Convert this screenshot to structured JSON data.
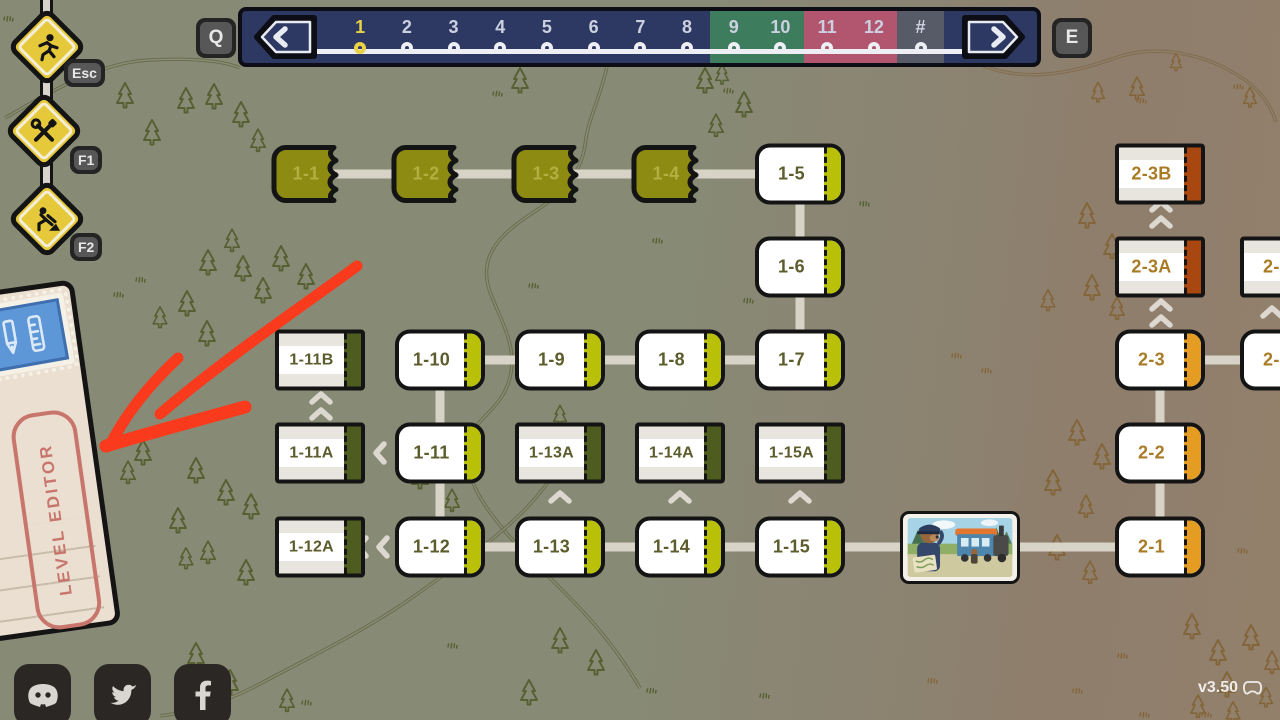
{
  "meta": {
    "version_label": "v3.50"
  },
  "topbar": {
    "prev_key": "Q",
    "next_key": "E",
    "current_world": "1",
    "worlds": [
      {
        "label": "1",
        "group": "navy"
      },
      {
        "label": "2",
        "group": "navy"
      },
      {
        "label": "3",
        "group": "navy"
      },
      {
        "label": "4",
        "group": "navy"
      },
      {
        "label": "5",
        "group": "navy"
      },
      {
        "label": "6",
        "group": "navy"
      },
      {
        "label": "7",
        "group": "navy"
      },
      {
        "label": "8",
        "group": "navy"
      },
      {
        "label": "9",
        "group": "green"
      },
      {
        "label": "10",
        "group": "green"
      },
      {
        "label": "11",
        "group": "red"
      },
      {
        "label": "12",
        "group": "red"
      },
      {
        "label": "#",
        "group": "gray"
      }
    ]
  },
  "hotkeys": [
    {
      "key": "Esc",
      "action": "exit",
      "icon": "runner-icon"
    },
    {
      "key": "F1",
      "action": "settings",
      "icon": "tools-icon"
    },
    {
      "key": "F2",
      "action": "construction",
      "icon": "worker-icon"
    }
  ],
  "level_editor": {
    "label": "LEVEL EDITOR"
  },
  "social": [
    {
      "name": "discord"
    },
    {
      "name": "twitter"
    },
    {
      "name": "facebook"
    }
  ],
  "colors": {
    "world1_stub": "#b9c008",
    "world1_bonus_stub": "#4e5c1f",
    "world1_done": "#8d8b11",
    "world2_stub": "#e49d22",
    "world2_bonus_stub": "#a8470f",
    "bar_navy": "#2e3963",
    "bar_green": "#3e7c5e",
    "bar_red": "#b2556e",
    "bar_gray": "#575b68",
    "highlight_yellow": "#e9d344",
    "sign_yellow": "#e6c93a",
    "path_gray": "#d8d3c7"
  },
  "map": {
    "nodes": [
      {
        "id": "1-1",
        "x": 315,
        "y": 174,
        "style": "done"
      },
      {
        "id": "1-2",
        "x": 435,
        "y": 174,
        "style": "done"
      },
      {
        "id": "1-3",
        "x": 555,
        "y": 174,
        "style": "done"
      },
      {
        "id": "1-4",
        "x": 675,
        "y": 174,
        "style": "done"
      },
      {
        "id": "1-5",
        "x": 800,
        "y": 174,
        "style": "open1"
      },
      {
        "id": "1-6",
        "x": 800,
        "y": 267,
        "style": "open1"
      },
      {
        "id": "1-7",
        "x": 800,
        "y": 360,
        "style": "open1"
      },
      {
        "id": "1-8",
        "x": 680,
        "y": 360,
        "style": "open1"
      },
      {
        "id": "1-9",
        "x": 560,
        "y": 360,
        "style": "open1"
      },
      {
        "id": "1-10",
        "x": 440,
        "y": 360,
        "style": "open1"
      },
      {
        "id": "1-11B",
        "x": 320,
        "y": 360,
        "style": "var1"
      },
      {
        "id": "1-11A",
        "x": 320,
        "y": 453,
        "style": "var1"
      },
      {
        "id": "1-11",
        "x": 440,
        "y": 453,
        "style": "open1"
      },
      {
        "id": "1-13A",
        "x": 560,
        "y": 453,
        "style": "var1"
      },
      {
        "id": "1-14A",
        "x": 680,
        "y": 453,
        "style": "var1"
      },
      {
        "id": "1-15A",
        "x": 800,
        "y": 453,
        "style": "var1"
      },
      {
        "id": "1-12A",
        "x": 320,
        "y": 547,
        "style": "var1"
      },
      {
        "id": "1-12",
        "x": 440,
        "y": 547,
        "style": "open1"
      },
      {
        "id": "1-13",
        "x": 560,
        "y": 547,
        "style": "open1"
      },
      {
        "id": "1-14",
        "x": 680,
        "y": 547,
        "style": "open1"
      },
      {
        "id": "1-15",
        "x": 800,
        "y": 547,
        "style": "open1"
      },
      {
        "id": "2-1",
        "x": 1160,
        "y": 547,
        "style": "open2"
      },
      {
        "id": "2-2",
        "x": 1160,
        "y": 453,
        "style": "open2"
      },
      {
        "id": "2-3",
        "x": 1160,
        "y": 360,
        "style": "open2"
      },
      {
        "id": "2-3A",
        "x": 1160,
        "y": 267,
        "style": "var2"
      },
      {
        "id": "2-3B",
        "x": 1160,
        "y": 174,
        "style": "var2"
      },
      {
        "id": "2-4",
        "x": 1285,
        "y": 267,
        "style": "var2"
      },
      {
        "id": "2-4",
        "x": 1285,
        "y": 360,
        "style": "open2"
      }
    ],
    "paths": [
      {
        "x1": 315,
        "y1": 174,
        "x2": 800,
        "y2": 174
      },
      {
        "x1": 800,
        "y1": 174,
        "x2": 800,
        "y2": 360
      },
      {
        "x1": 440,
        "y1": 360,
        "x2": 800,
        "y2": 360
      },
      {
        "x1": 440,
        "y1": 360,
        "x2": 440,
        "y2": 547
      },
      {
        "x1": 440,
        "y1": 547,
        "x2": 1160,
        "y2": 547
      },
      {
        "x1": 1160,
        "y1": 547,
        "x2": 1160,
        "y2": 360
      },
      {
        "x1": 1160,
        "y1": 360,
        "x2": 1290,
        "y2": 360
      }
    ],
    "chevrons": [
      {
        "x": 321,
        "y": 398,
        "dir": "up"
      },
      {
        "x": 321,
        "y": 414,
        "dir": "up"
      },
      {
        "x": 380,
        "y": 453,
        "dir": "left"
      },
      {
        "x": 362,
        "y": 547,
        "dir": "left"
      },
      {
        "x": 383,
        "y": 547,
        "dir": "left"
      },
      {
        "x": 560,
        "y": 497,
        "dir": "up"
      },
      {
        "x": 680,
        "y": 497,
        "dir": "up"
      },
      {
        "x": 800,
        "y": 497,
        "dir": "up"
      },
      {
        "x": 1161,
        "y": 206,
        "dir": "up"
      },
      {
        "x": 1161,
        "y": 222,
        "dir": "up"
      },
      {
        "x": 1161,
        "y": 305,
        "dir": "up"
      },
      {
        "x": 1161,
        "y": 321,
        "dir": "up"
      },
      {
        "x": 1272,
        "y": 312,
        "dir": "up"
      }
    ]
  }
}
